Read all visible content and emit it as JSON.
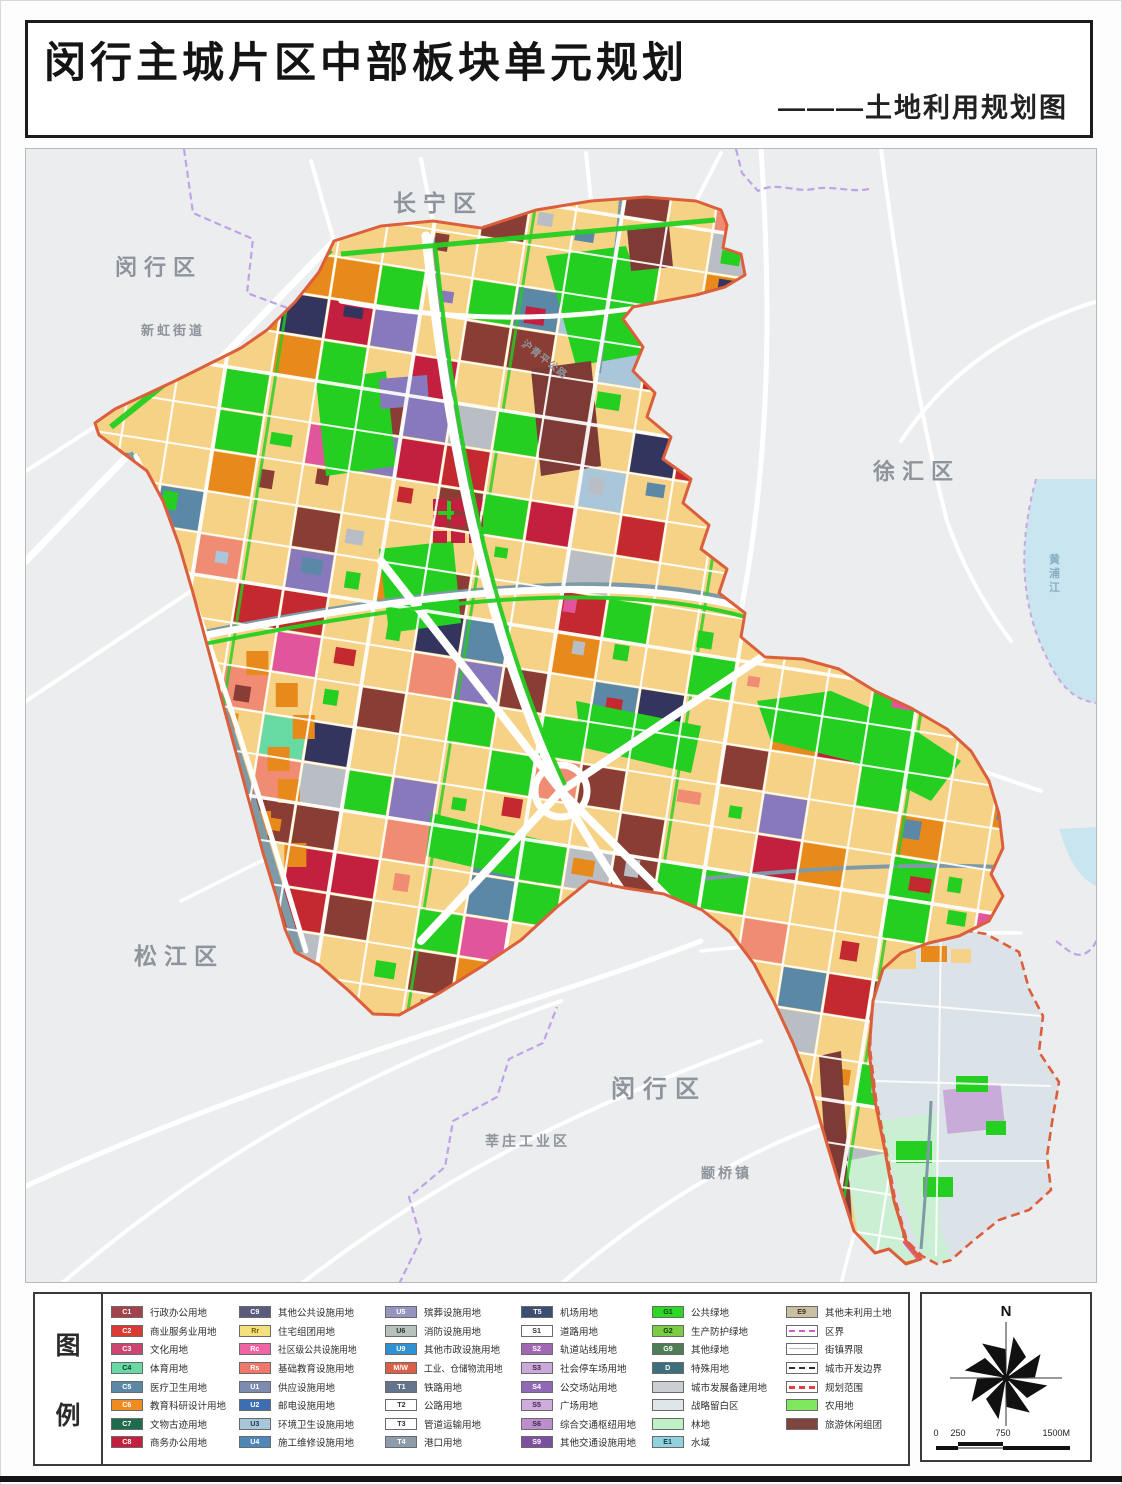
{
  "title": "闵行主城片区中部板块单元规划",
  "subtitle": "———土地利用规划图",
  "map": {
    "colors": {
      "background": "#ECEDEF",
      "residential": "#F6D287",
      "boundary": "#DC5F3B",
      "park_green": "#24CF21",
      "water": "#C9E6F0",
      "district_line": "#BFA3E6"
    },
    "labels": [
      {
        "text": "长宁区",
        "x": 392,
        "y": 210,
        "size": 23,
        "ls": 7
      },
      {
        "text": "闵行区",
        "x": 114,
        "y": 274,
        "size": 22,
        "ls": 7
      },
      {
        "text": "新虹街道",
        "x": 140,
        "y": 334,
        "size": 13,
        "ls": 3
      },
      {
        "text": "徐汇区",
        "x": 872,
        "y": 478,
        "size": 22,
        "ls": 7
      },
      {
        "text": "松江区",
        "x": 133,
        "y": 963,
        "size": 23,
        "ls": 7
      },
      {
        "text": "闵行区",
        "x": 610,
        "y": 1096,
        "size": 24,
        "ls": 8
      },
      {
        "text": "莘庄工业区",
        "x": 484,
        "y": 1145,
        "size": 14,
        "ls": 3
      },
      {
        "text": "颛桥镇",
        "x": 700,
        "y": 1177,
        "size": 14,
        "ls": 3
      },
      {
        "text": "沪青平公路",
        "x": 520,
        "y": 344,
        "size": 10,
        "ls": 1,
        "rotate": 38
      },
      {
        "text": "黄浦江",
        "x": 1048,
        "y": 562,
        "size": 11,
        "ls": 0,
        "vertical": true,
        "color": "#86aec2"
      }
    ]
  },
  "legend": {
    "title_chars": [
      "图",
      "例"
    ],
    "columns": [
      {
        "width": 128,
        "entries": [
          {
            "code": "C1",
            "label": "行政办公用地",
            "color": "#A3424A",
            "text": "#fff"
          },
          {
            "code": "C2",
            "label": "商业服务业用地",
            "color": "#D93A31",
            "text": "#fff"
          },
          {
            "code": "C3",
            "label": "文化用地",
            "color": "#CC4470",
            "text": "#fff"
          },
          {
            "code": "C4",
            "label": "体育用地",
            "color": "#67D9A3",
            "text": "#10403a"
          },
          {
            "code": "C5",
            "label": "医疗卫生用地",
            "color": "#5C88A8",
            "text": "#fff"
          },
          {
            "code": "C6",
            "label": "教育科研设计用地",
            "color": "#EF8B20",
            "text": "#fff"
          },
          {
            "code": "C7",
            "label": "文物古迹用地",
            "color": "#1E6B4E",
            "text": "#fff"
          },
          {
            "code": "C8",
            "label": "商务办公用地",
            "color": "#C2203E",
            "text": "#fff"
          }
        ]
      },
      {
        "width": 146,
        "entries": [
          {
            "code": "C9",
            "label": "其他公共设施用地",
            "color": "#5A5B7D",
            "text": "#fff"
          },
          {
            "code": "Rr",
            "label": "住宅组团用地",
            "color": "#F4E07E",
            "text": "#7a5c00"
          },
          {
            "code": "Rc",
            "label": "社区级公共设施用地",
            "color": "#F063A4",
            "text": "#fff"
          },
          {
            "code": "Rs",
            "label": "基础教育设施用地",
            "color": "#F0766A",
            "text": "#fff"
          },
          {
            "code": "U1",
            "label": "供应设施用地",
            "color": "#7D8BB0",
            "text": "#fff"
          },
          {
            "code": "U2",
            "label": "邮电设施用地",
            "color": "#3D6EB2",
            "text": "#fff"
          },
          {
            "code": "U3",
            "label": "环境卫生设施用地",
            "color": "#A9C6DB",
            "text": "#223a4a"
          },
          {
            "code": "U4",
            "label": "施工维修设施用地",
            "color": "#4F87B8",
            "text": "#fff"
          }
        ]
      },
      {
        "width": 136,
        "entries": [
          {
            "code": "U5",
            "label": "殡葬设施用地",
            "color": "#9695C0",
            "text": "#fff"
          },
          {
            "code": "U6",
            "label": "消防设施用地",
            "color": "#B8C2BC",
            "text": "#253530"
          },
          {
            "code": "U9",
            "label": "其他市政设施用地",
            "color": "#2F90D2",
            "text": "#fff"
          },
          {
            "code": "M/W",
            "label": "工业、仓储物流用地",
            "color": "#D96047",
            "text": "#fff"
          },
          {
            "code": "T1",
            "label": "铁路用地",
            "color": "#64748C",
            "text": "#fff"
          },
          {
            "code": "T2",
            "label": "公路用地",
            "color": "#FFFFFF",
            "text": "#333"
          },
          {
            "code": "T3",
            "label": "管道运输用地",
            "color": "#FFFFFF",
            "text": "#333"
          },
          {
            "code": "T4",
            "label": "港口用地",
            "color": "#8C9CAB",
            "text": "#fff"
          }
        ]
      },
      {
        "width": 131,
        "entries": [
          {
            "code": "T5",
            "label": "机场用地",
            "color": "#3E4E72",
            "text": "#fff"
          },
          {
            "code": "S1",
            "label": "道路用地",
            "color": "#FFFFFF",
            "text": "#333"
          },
          {
            "code": "S2",
            "label": "轨道站线用地",
            "color": "#A167B2",
            "text": "#fff"
          },
          {
            "code": "S3",
            "label": "社会停车场用地",
            "color": "#CBA9DB",
            "text": "#3a2a45"
          },
          {
            "code": "S4",
            "label": "公交场站用地",
            "color": "#8F69B8",
            "text": "#fff"
          },
          {
            "code": "S5",
            "label": "广场用地",
            "color": "#CFABDE",
            "text": "#3a2a45"
          },
          {
            "code": "S6",
            "label": "综合交通枢纽用地",
            "color": "#BC8ECC",
            "text": "#3a2a45"
          },
          {
            "code": "S9",
            "label": "其他交通设施用地",
            "color": "#7C4FA0",
            "text": "#fff"
          }
        ]
      },
      {
        "width": 134,
        "entries": [
          {
            "code": "G1",
            "label": "公共绿地",
            "color": "#2BD926",
            "text": "#0b3d08"
          },
          {
            "code": "G2",
            "label": "生产防护绿地",
            "color": "#79CE44",
            "text": "#0b3d08"
          },
          {
            "code": "G9",
            "label": "其他绿地",
            "color": "#4E7D56",
            "text": "#fff"
          },
          {
            "code": "D",
            "label": "特殊用地",
            "color": "#3E6F7C",
            "text": "#fff"
          },
          {
            "code": "",
            "label": "城市发展备建用地",
            "color": "#CBCFD3",
            "text": "#333"
          },
          {
            "code": "",
            "label": "战略留白区",
            "color": "#DEE6EA",
            "text": "#333"
          },
          {
            "code": "",
            "label": "林地",
            "color": "#BFF0C8",
            "text": "#333"
          },
          {
            "code": "E1",
            "label": "水域",
            "color": "#92D2DF",
            "text": "#123a4a"
          }
        ]
      },
      {
        "width": 118,
        "entries": [
          {
            "code": "E9",
            "label": "其他未利用土地",
            "color": "#C9BFA4",
            "text": "#3a3220"
          },
          {
            "code": "",
            "label": "区界",
            "type": "line",
            "line": "#D05CD0",
            "style": "dashed",
            "weight": 2
          },
          {
            "code": "",
            "label": "街镇界限",
            "type": "line",
            "line": "#b9b9b9",
            "style": "solid",
            "weight": 1
          },
          {
            "code": "",
            "label": "城市开发边界",
            "type": "line",
            "line": "#2e2e2e",
            "style": "dashed",
            "weight": 2
          },
          {
            "code": "",
            "label": "规划范围",
            "type": "line",
            "line": "#E04040",
            "style": "dashed",
            "weight": 3
          },
          {
            "code": "",
            "label": "农用地",
            "color": "#7EE95E",
            "text": "#0b3d08"
          },
          {
            "code": "",
            "label": "旅游休闲组团",
            "color": "#7C4540",
            "text": "#fff"
          }
        ]
      }
    ]
  },
  "compass": {
    "north": "N",
    "scale_labels": [
      "0",
      "250",
      "750",
      "1500M"
    ]
  }
}
